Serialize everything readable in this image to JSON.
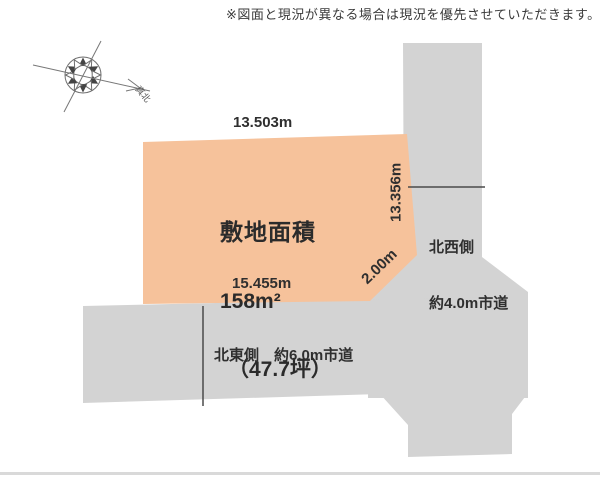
{
  "disclaimer": "※図面と現況が異なる場合は現況を優先させていただきます。",
  "compass": {
    "label": "真北"
  },
  "plot": {
    "fill": "#f6c29b",
    "area_title": "敷地面積",
    "area_m2": "158m²",
    "area_tsubo": "（47.7坪）",
    "dim_top": "13.503m",
    "dim_right": "13.356m",
    "dim_bottom": "15.455m",
    "dim_chamfer": "2.00m"
  },
  "roads": {
    "fill": "#d3d3d3",
    "northwest": {
      "line1": "北西側",
      "line2": "約4.0m市道"
    },
    "northeast": {
      "label": "北東側　約6.0m市道"
    }
  },
  "colors": {
    "tick_line": "#4a4a4a",
    "bottom_bar": "#d9d9d9"
  }
}
